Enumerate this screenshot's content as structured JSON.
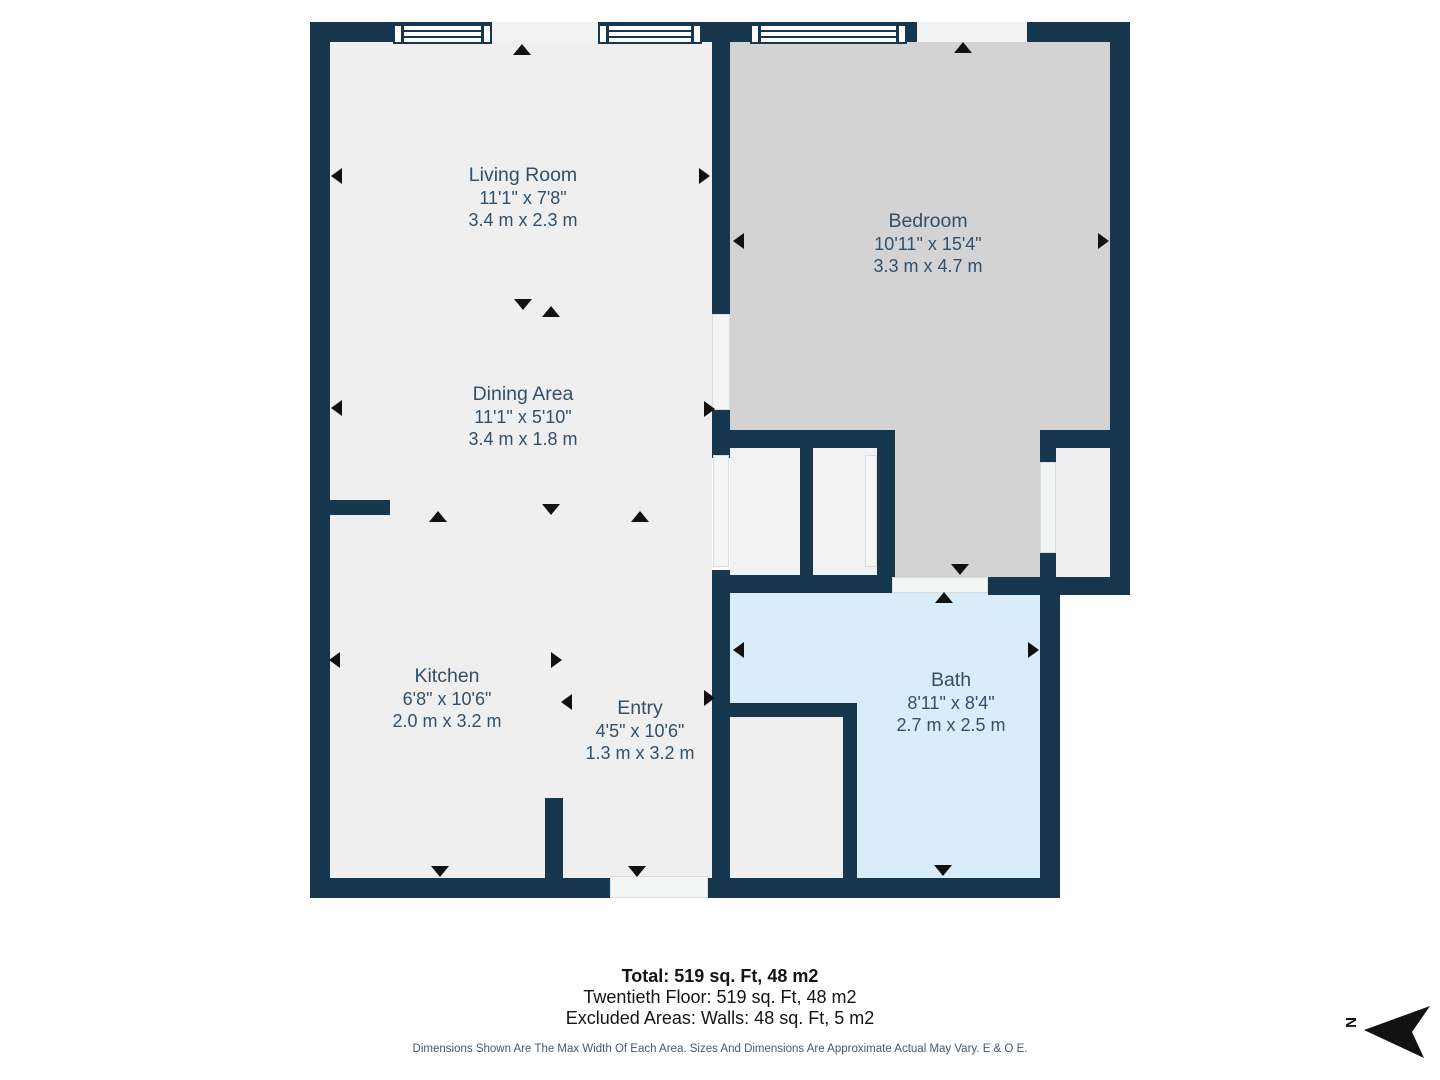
{
  "plan": {
    "rooms": [
      {
        "id": "living-room",
        "name": "Living Room",
        "imperial": "11'1\" x 7'8\"",
        "metric": "3.4 m x 2.3 m"
      },
      {
        "id": "bedroom",
        "name": "Bedroom",
        "imperial": "10'11\" x 15'4\"",
        "metric": "3.3 m x 4.7 m"
      },
      {
        "id": "dining-area",
        "name": "Dining Area",
        "imperial": "11'1\" x 5'10\"",
        "metric": "3.4 m x 1.8 m"
      },
      {
        "id": "kitchen",
        "name": "Kitchen",
        "imperial": "6'8\" x 10'6\"",
        "metric": "2.0 m x 3.2 m"
      },
      {
        "id": "entry",
        "name": "Entry",
        "imperial": "4'5\" x 10'6\"",
        "metric": "1.3 m x 3.2 m"
      },
      {
        "id": "bath",
        "name": "Bath",
        "imperial": "8'11\" x 8'4\"",
        "metric": "2.7 m x 2.5 m"
      }
    ],
    "summary": {
      "total": "Total: 519 sq. Ft, 48 m2",
      "floor_line": "Twentieth Floor: 519 sq. Ft, 48 m2",
      "excluded": "Excluded Areas: Walls: 48 sq. Ft, 5 m2",
      "disclaimer": "Dimensions Shown Are The Max Width Of Each Area. Sizes And Dimensions Are Approximate Actual May Vary. E & O E."
    },
    "compass": {
      "label": "N"
    },
    "colors": {
      "wall": "#16374D",
      "floor": "#EFEFEF",
      "bedroom_floor": "#D3D3D3",
      "bath_floor": "#D9ECFA",
      "door_strip": "#F4F5F5",
      "marker": "#111111",
      "label_text": "#31506B"
    }
  }
}
